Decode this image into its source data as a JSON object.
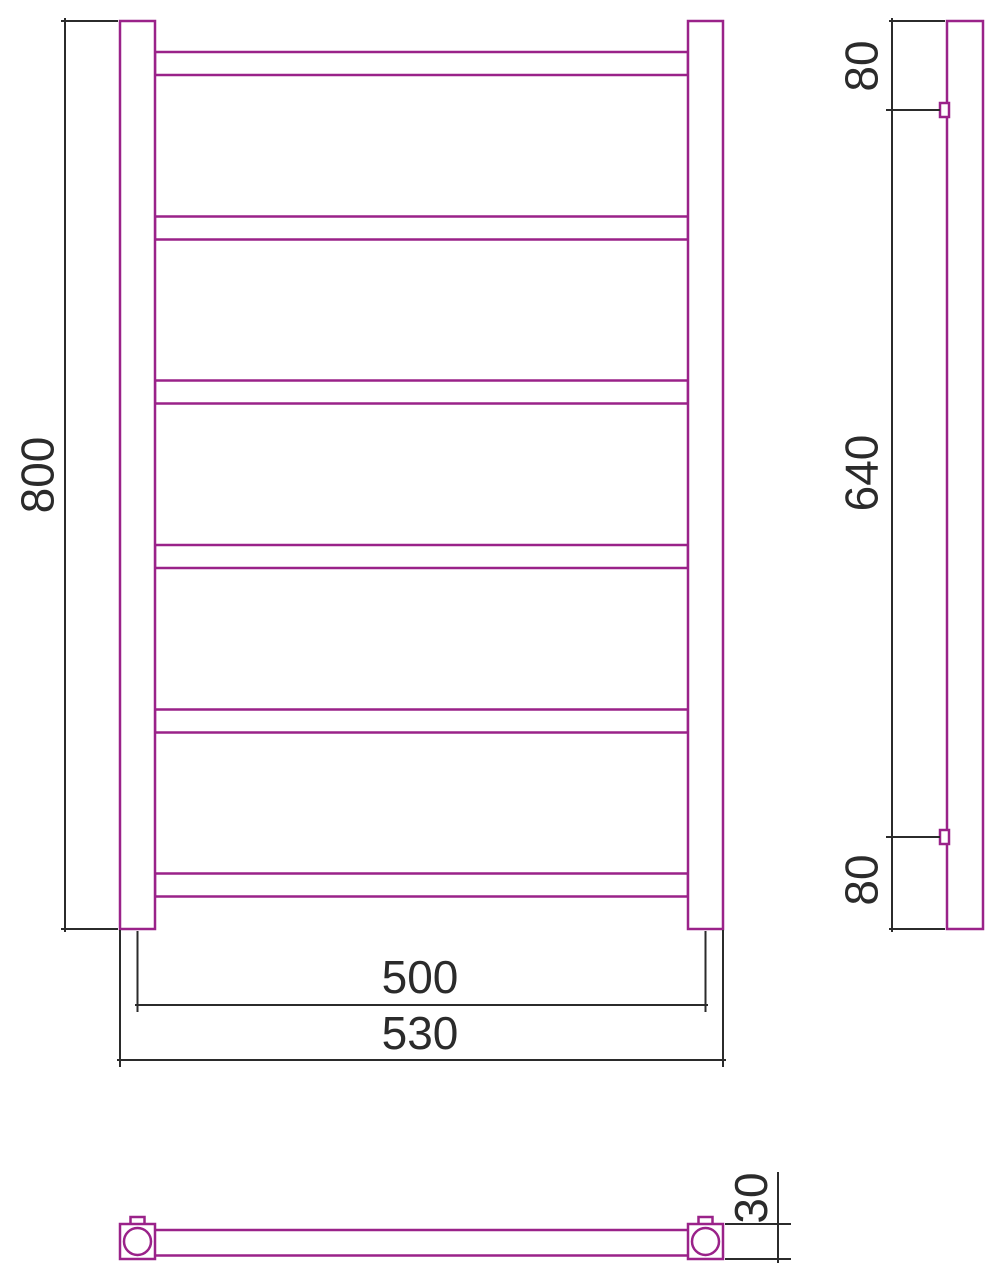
{
  "drawing": {
    "type": "technical-dimension-drawing",
    "subject": "ladder-towel-rail",
    "views": {
      "front": {
        "rung_count": 6
      },
      "side": {
        "bracket_count": 2
      },
      "plan": {
        "end_caps": 2
      }
    }
  },
  "colors": {
    "outline": "#9A2289",
    "dimension": "#2B2B2B"
  },
  "dimensions": {
    "front_height": "800",
    "front_axis_width": "500",
    "front_overall_width": "530",
    "side_top_offset": "80",
    "side_bracket_span": "640",
    "side_bottom_offset": "80",
    "plan_depth": "30"
  }
}
